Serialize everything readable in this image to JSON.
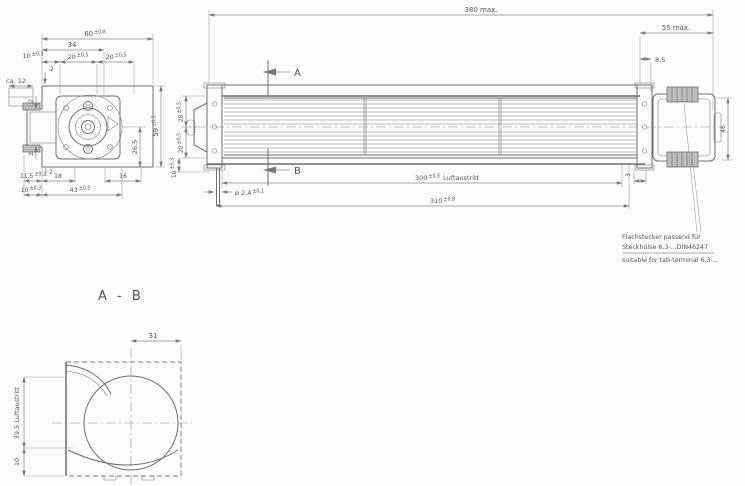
{
  "colors": {
    "background": "#fcfcfc",
    "line": "#6f6f6f",
    "dimension": "#8c8c8c",
    "text": "#565656"
  },
  "front_view": {
    "dim_60": {
      "v": "60",
      "tol": "±0,8"
    },
    "dim_34": {
      "v": "34"
    },
    "dim_10_top": {
      "v": "10",
      "tol": "±0,3"
    },
    "dim_20_left": {
      "v": "20",
      "tol": "±0,5"
    },
    "dim_20_right": {
      "v": "20",
      "tol": "±0,5"
    },
    "dim_2_top": {
      "v": "2"
    },
    "dim_ca12": {
      "v": "ca. 12"
    },
    "dim_2_upper": {
      "v": "2"
    },
    "dim_2_lower": {
      "v": "2"
    },
    "dim_59": {
      "v": "59",
      "tol": "±0,5"
    },
    "dim_26_5": {
      "v": "26,5"
    },
    "dim_11_5": {
      "v": "11,5",
      "tol": "±0,2"
    },
    "dim_18": {
      "v": "18"
    },
    "dim_16": {
      "v": "16"
    },
    "dim_2_bottom": {
      "v": "2"
    },
    "dim_10_bottom": {
      "v": "10",
      "tol": "±0,3"
    },
    "dim_43": {
      "v": "43",
      "tol": "±0,5"
    }
  },
  "side_view": {
    "dim_380": {
      "v": "380 max."
    },
    "dim_55": {
      "v": "55 max."
    },
    "dim_8_5": {
      "v": "8,5"
    },
    "dim_20_upper": {
      "v": "20",
      "tol": "±0,5"
    },
    "dim_20_lower": {
      "v": "20",
      "tol": "±0,5"
    },
    "dim_10": {
      "v": "10",
      "tol": "±0,3"
    },
    "dim_shaft": {
      "v": "ø 2,4",
      "tol": "±0,1"
    },
    "dim_300": {
      "v": "300",
      "tol": "±0,5",
      "suffix": " Luftaustritt"
    },
    "dim_310": {
      "v": "310",
      "tol": "±0,8"
    },
    "dim_46": {
      "v": "46"
    },
    "dim_3": {
      "v": "3"
    },
    "marker_a": "A",
    "marker_b": "B"
  },
  "section_view": {
    "title": "A - B",
    "dim_31": {
      "v": "31"
    },
    "dim_39_5": {
      "v": "39,5 Luftaustritt"
    },
    "dim_10": {
      "v": "10"
    }
  },
  "note": {
    "line1_de": "Flachstecker passend für",
    "line2_de": "Steckhülse 6,3-...DIN46247",
    "line3_en": "suitable for tab-terminal 6,3-..."
  }
}
